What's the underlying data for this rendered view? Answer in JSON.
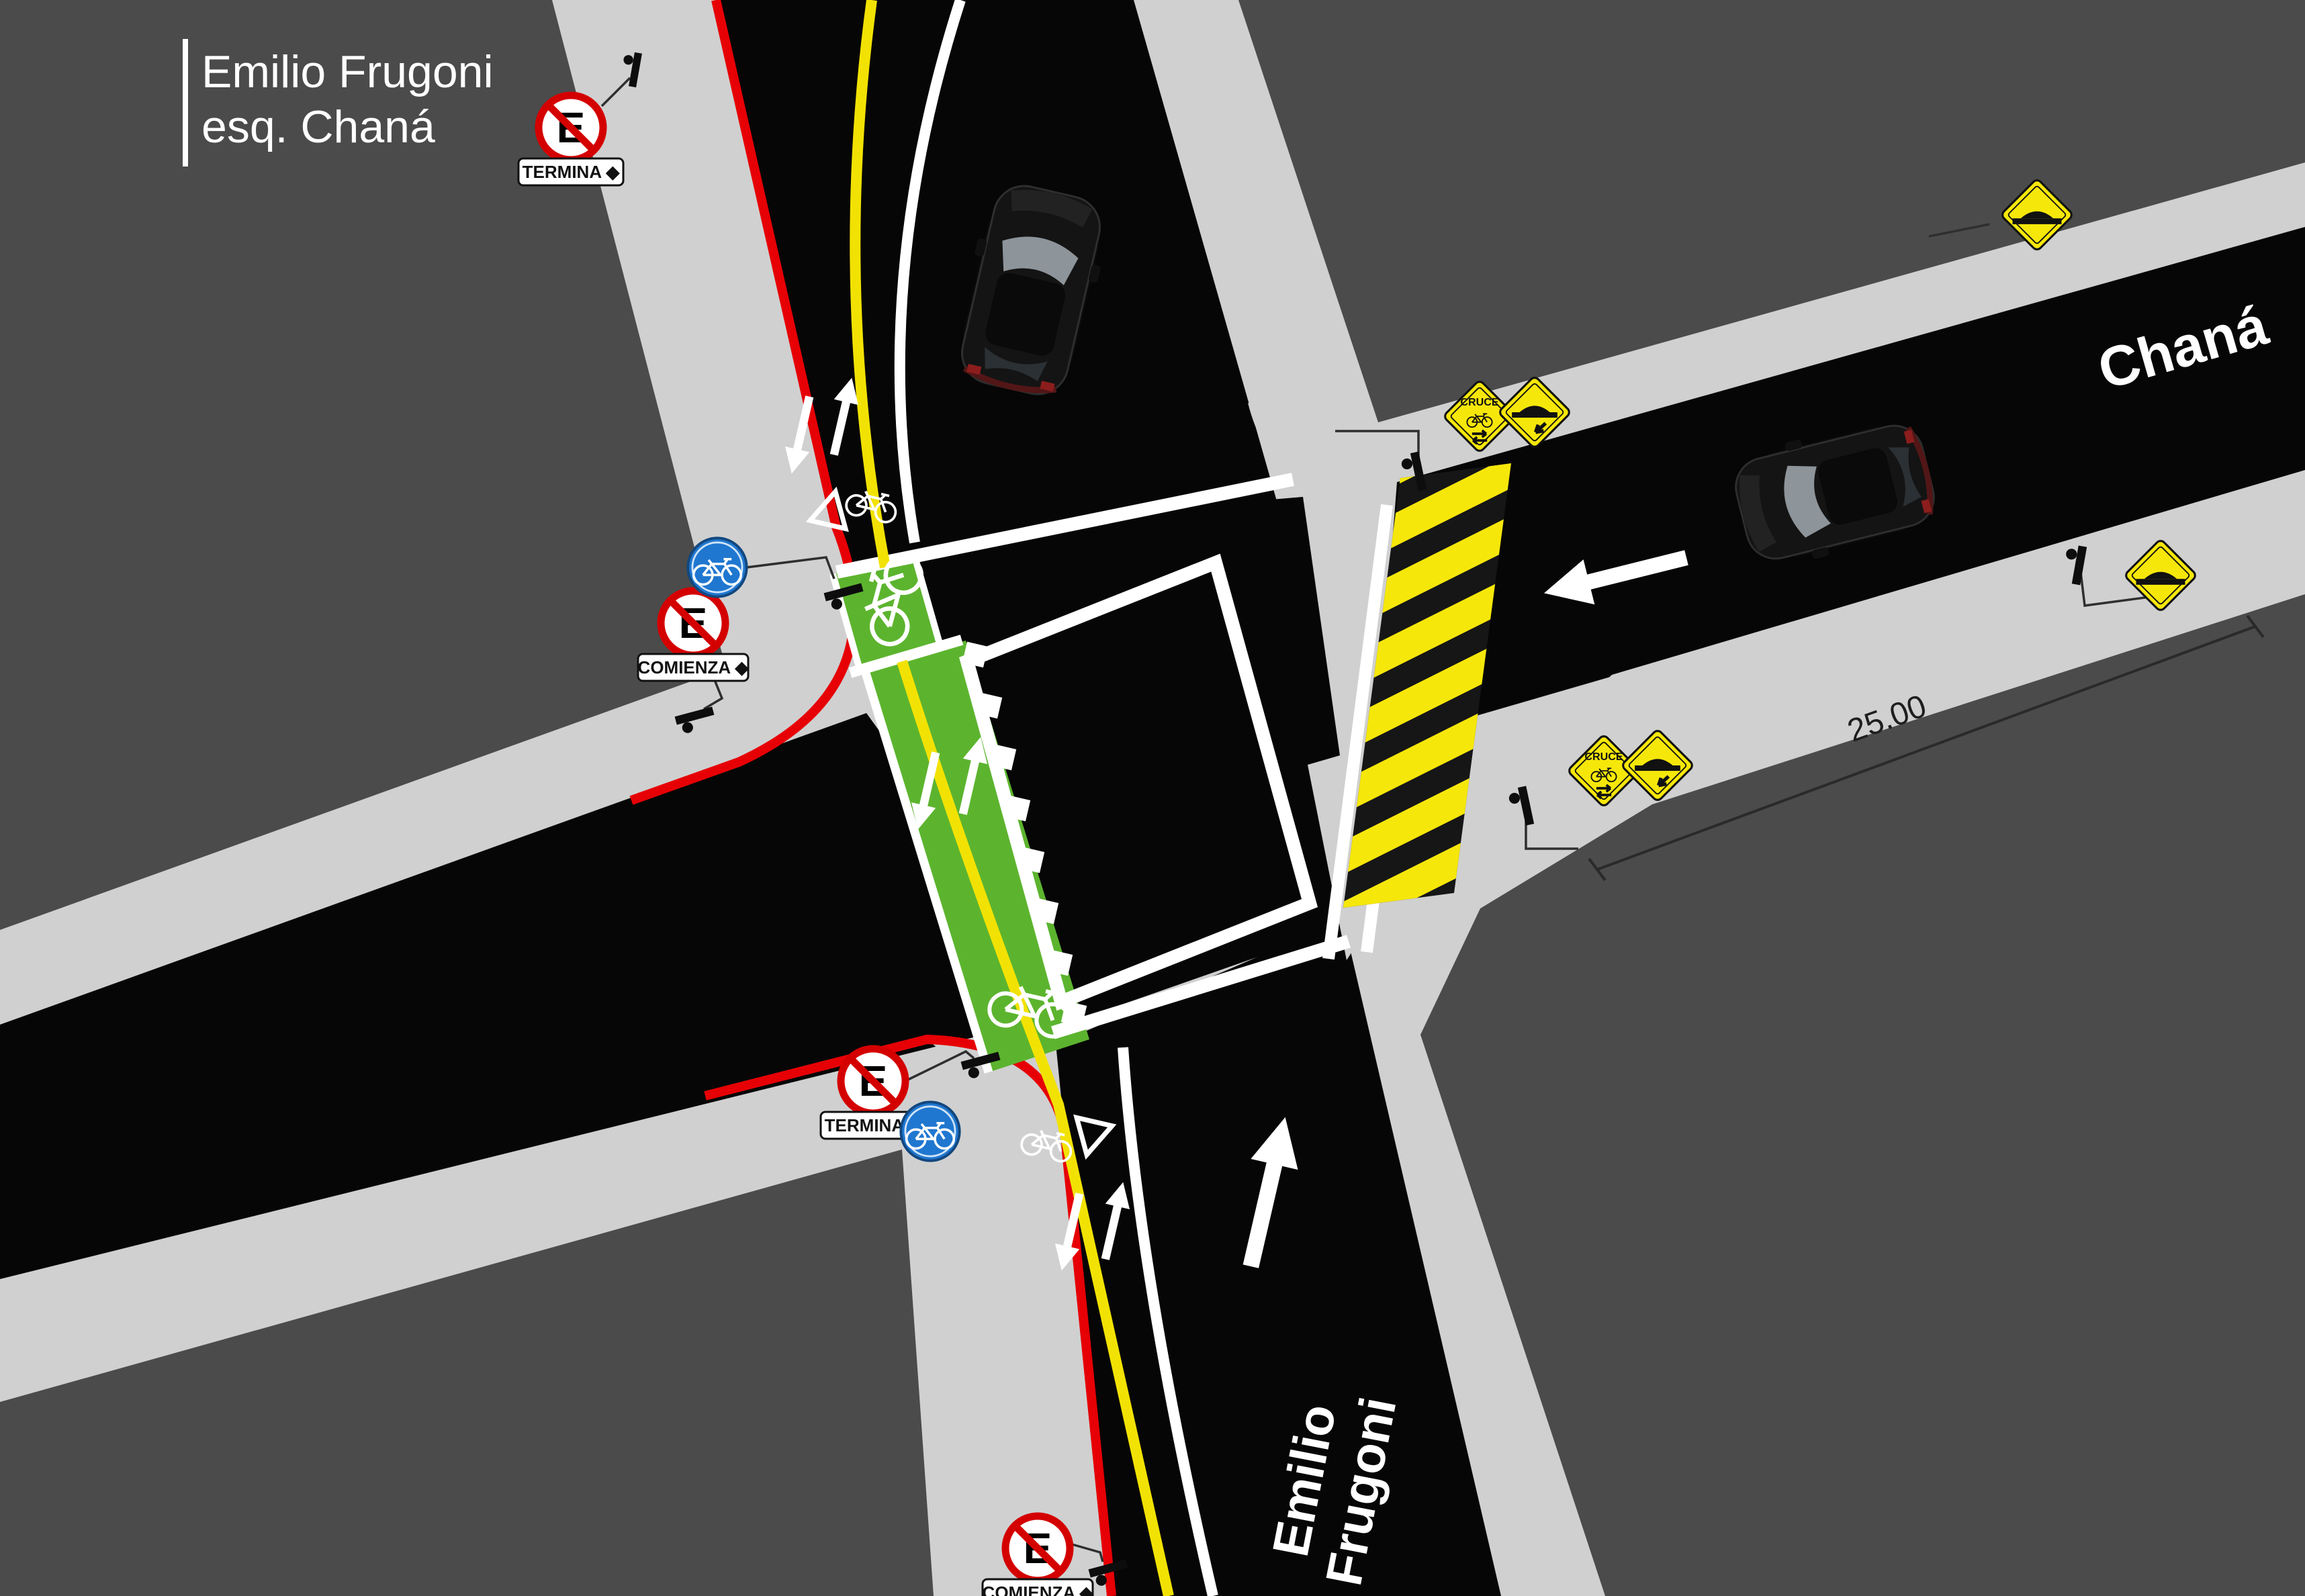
{
  "title": {
    "line1": "Emilio Frugoni",
    "line2": "esq. Chaná"
  },
  "street_labels": {
    "chana": "Chaná",
    "emilio_line1": "Emilio",
    "emilio_line2": "Frugoni"
  },
  "dimension": {
    "length_label": "25.00"
  },
  "signs": {
    "no_parking_letter": "E",
    "plate_termina": "TERMINA ◆",
    "plate_comienza": "COMIENZA ◆",
    "bike_crossing_label": "CRUCE"
  },
  "colors": {
    "background": "#4b4b4b",
    "sidewalk": "#d0d0d0",
    "road": "#060606",
    "bike_lane_green": "#5cb42e",
    "center_line_yellow": "#f2e203",
    "curb_red": "#e60005",
    "warning_yellow": "#f6e70a",
    "sign_blue": "#2077d0",
    "no_parking_red": "#d40000",
    "marking_white": "#ffffff"
  }
}
